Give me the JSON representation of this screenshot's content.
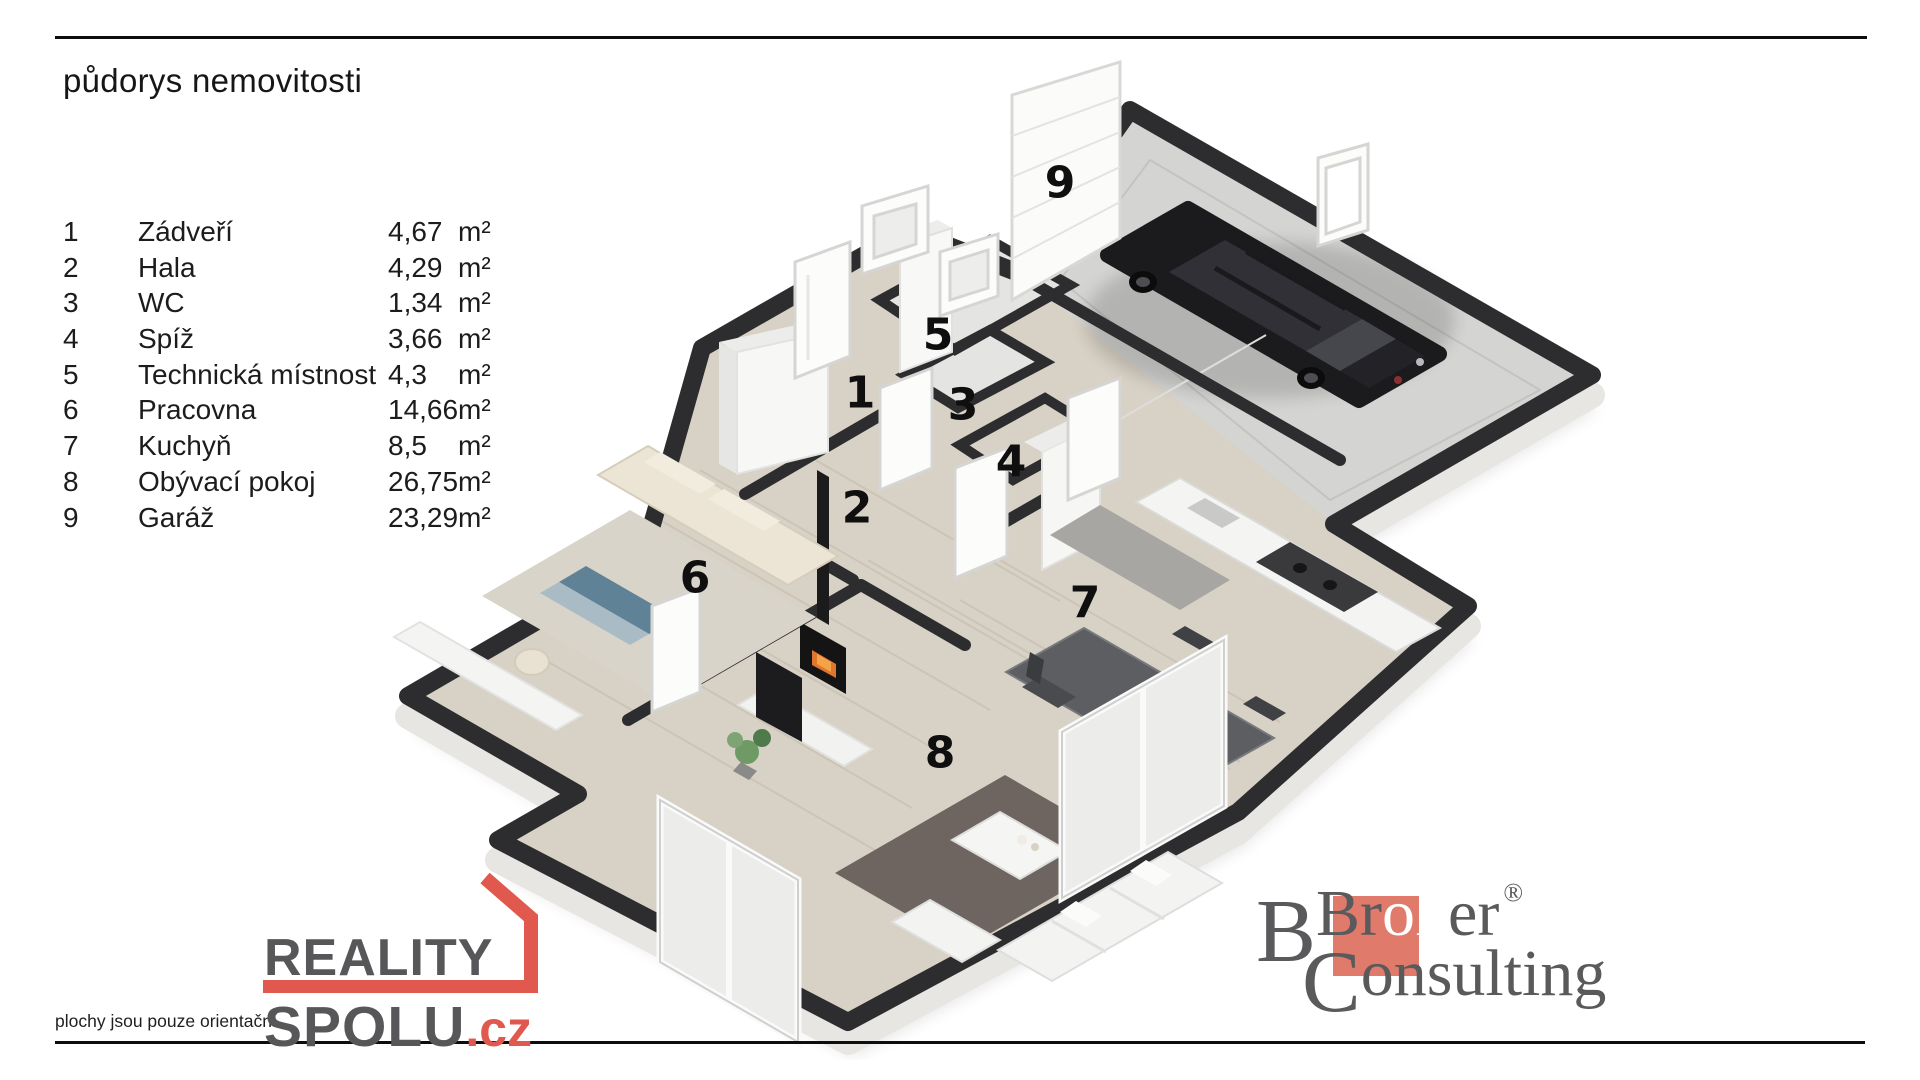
{
  "title": "půdorys nemovitosti",
  "rooms": [
    {
      "num": "1",
      "name": "Zádveří",
      "area": "4,67",
      "unit": "m²"
    },
    {
      "num": "2",
      "name": "Hala",
      "area": "4,29",
      "unit": "m²"
    },
    {
      "num": "3",
      "name": "WC",
      "area": "1,34",
      "unit": "m²"
    },
    {
      "num": "4",
      "name": "Spíž",
      "area": "3,66",
      "unit": "m²"
    },
    {
      "num": "5",
      "name": "Technická místnost",
      "area": "4,3",
      "unit": "m²"
    },
    {
      "num": "6",
      "name": "Pracovna",
      "area": "14,66",
      "unit": "m²"
    },
    {
      "num": "7",
      "name": "Kuchyň",
      "area": "8,5",
      "unit": "m²"
    },
    {
      "num": "8",
      "name": "Obývací pokoj",
      "area": "26,75",
      "unit": "m²"
    },
    {
      "num": "9",
      "name": "Garáž",
      "area": "23,29",
      "unit": "m²"
    }
  ],
  "footer": {
    "disclaimer": "plochy jsou pouze orientační"
  },
  "logos": {
    "reality_spolu": {
      "line1": "REALITY",
      "line2": "SPOLU",
      "tld": ".cz",
      "accent_color": "#e0584e",
      "gray_color": "#57575a"
    },
    "broker_consulting": {
      "word1_pre": "Br",
      "word1_highlight": "ok",
      "word1_post": "er",
      "registered_mark": "®",
      "word2_initial": "C",
      "word2_rest": "onsulting",
      "accent_color": "#e07a6a",
      "gray_color": "#5a5a5c"
    }
  },
  "plan_colors": {
    "wall": "#2d2d2f",
    "wood_floor": "#d8d1c5",
    "garage_floor": "#d4d4d2",
    "tile_floor": "#e4e4e2",
    "car_body": "#1b1b1e"
  }
}
